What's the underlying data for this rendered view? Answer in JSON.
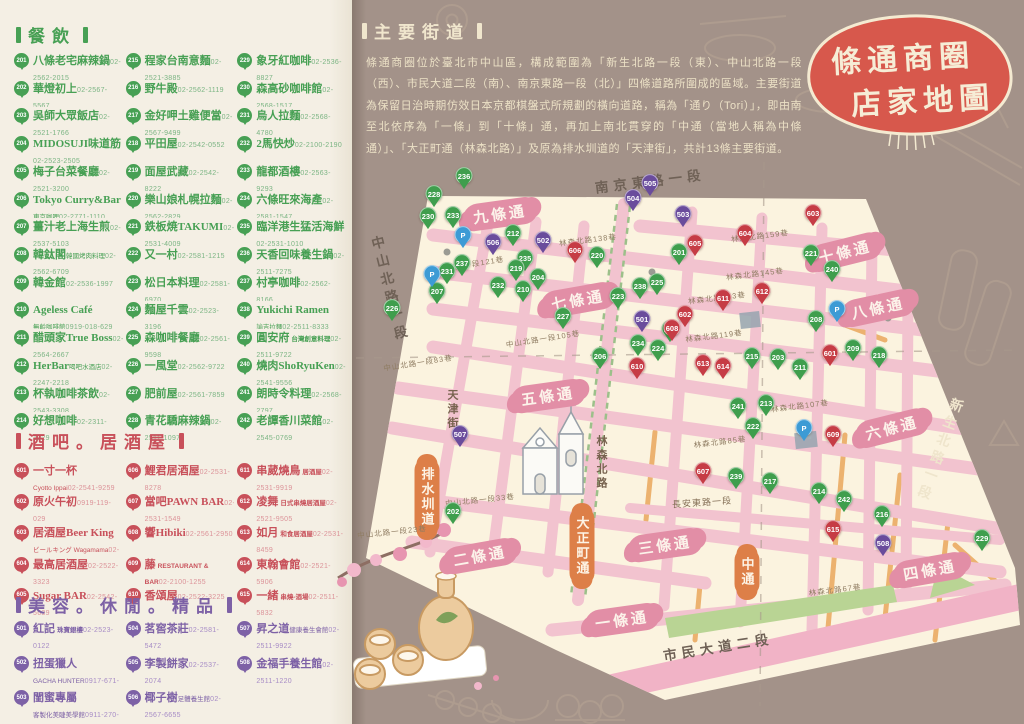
{
  "meta": {
    "title_line1": "條通商圈",
    "title_line2": "店家地圖"
  },
  "colors": {
    "accent_red": "#d7584c",
    "dining_green": "#47a054",
    "bar_red": "#c8505a",
    "beauty_purple": "#7d61a6",
    "map_cream": "#fbf3df",
    "road_pink": "#f2c3cf",
    "band_pink": "#e28ea6",
    "orange": "#dd7f48",
    "cream_text": "#efe5cc",
    "background_brown": "#a39289"
  },
  "sections": {
    "dining": {
      "title": "餐飲",
      "items": [
        {
          "n": 201,
          "name": "八條老宅麻辣鍋",
          "tel": "02-2562-2015"
        },
        {
          "n": 202,
          "name": "華燈初上",
          "tel": "02-2567-5567"
        },
        {
          "n": 203,
          "name": "吳師大眾飯店",
          "tel": "02-2521-1766"
        },
        {
          "n": 204,
          "name": "MIDOSUJI味道筋",
          "tel": "02-2523-2505"
        },
        {
          "n": 205,
          "name": "梅子台菜餐廳",
          "tel": "02-2521-3200"
        },
        {
          "n": 206,
          "name": "Tokyo Curry&Bar",
          "sub": "東京咖哩",
          "tel": "02-2771-1110"
        },
        {
          "n": 207,
          "name": "薑汁老上海生煎",
          "tel": "02-2537-5103"
        },
        {
          "n": 208,
          "name": "韓鈦閣",
          "sub": "韓國烤肉料理",
          "tel": "02-2562-6709"
        },
        {
          "n": 209,
          "name": "韓金館",
          "tel": "02-2536-1997"
        },
        {
          "n": 210,
          "name": "Ageless Café",
          "sub": "無齡咖啡館",
          "tel": "0919-018-629"
        },
        {
          "n": 211,
          "name": "醋頭家True Boss",
          "tel": "02-2564-2667"
        },
        {
          "n": 212,
          "name": "HerBar",
          "sub": "喝吧水酒店",
          "tel": "02-2247-2218"
        },
        {
          "n": 213,
          "name": "杯執咖啡茶飲",
          "tel": "02-2543-3308"
        },
        {
          "n": 214,
          "name": "好想咖啡",
          "tel": "02-2311-1329"
        },
        {
          "n": 215,
          "name": "程家台南意麵",
          "tel": "02-2521-3885"
        },
        {
          "n": 216,
          "name": "野牛殿",
          "tel": "02-2562-1119"
        },
        {
          "n": 217,
          "name": "金好呷土雞便當",
          "tel": "02-2567-9499"
        },
        {
          "n": 218,
          "name": "平田屋",
          "tel": "02-2542-0552"
        },
        {
          "n": 219,
          "name": "面屋武藏",
          "tel": "02-2542-8222"
        },
        {
          "n": 220,
          "name": "樂山娘札幌拉麵",
          "tel": "02-2562-2829"
        },
        {
          "n": 221,
          "name": "鉄板焼TAKUMI",
          "tel": "02-2531-4009"
        },
        {
          "n": 222,
          "name": "又一村",
          "tel": "02-2581-1215"
        },
        {
          "n": 223,
          "name": "松日本料理",
          "tel": "02-2581-6970"
        },
        {
          "n": 224,
          "name": "麵屋千雲",
          "tel": "02-2523-3196"
        },
        {
          "n": 225,
          "name": "森咖啡餐廳",
          "tel": "02-2561-9598"
        },
        {
          "n": 226,
          "name": "一風堂",
          "tel": "02-2562-9722"
        },
        {
          "n": 227,
          "name": "肥前屋",
          "tel": "02-2561-7859"
        },
        {
          "n": 228,
          "name": "青花驕麻辣鍋",
          "tel": "02-2511-1097"
        },
        {
          "n": 229,
          "name": "象牙紅咖啡",
          "tel": "02-2536-8827"
        },
        {
          "n": 230,
          "name": "森高砂咖啡館",
          "tel": "02-2568-1517"
        },
        {
          "n": 231,
          "name": "烏人拉麵",
          "tel": "02-2568-4780"
        },
        {
          "n": 232,
          "name": "2馬快炒",
          "tel": "02-2100-2190"
        },
        {
          "n": 233,
          "name": "龍都酒樓",
          "tel": "02-2563-9293"
        },
        {
          "n": 234,
          "name": "六條旺來海產",
          "tel": "02-2581-1547"
        },
        {
          "n": 235,
          "name": "臨洋港生猛活海鮮",
          "tel": "02-2531-1010"
        },
        {
          "n": 236,
          "name": "天香回味養生鍋",
          "tel": "02-2511-7275"
        },
        {
          "n": 237,
          "name": "村亭咖啡",
          "tel": "02-2562-8166"
        },
        {
          "n": 238,
          "name": "Yukichi Ramen",
          "sub": "諭吉拉麵",
          "tel": "02-2511-8333"
        },
        {
          "n": 239,
          "name": "圓安府",
          "subi": "台灣創意料理",
          "tel": "02-2511-9722"
        },
        {
          "n": 240,
          "name": "燒肉ShoRyuKen",
          "tel": "02-2541-9556"
        },
        {
          "n": 241,
          "name": "朗時令料理",
          "tel": "02-2568-2797"
        },
        {
          "n": 242,
          "name": "老譚香川菜館",
          "tel": "02-2545-0769"
        }
      ]
    },
    "bars": {
      "title": "酒吧。居酒屋",
      "items": [
        {
          "n": 601,
          "name": "一寸一杯",
          "sub": "Cyotto Ippai",
          "tel": "02-2541-9259"
        },
        {
          "n": 602,
          "name": "原火午初",
          "tel": "0919-119-029"
        },
        {
          "n": 603,
          "name": "居酒屋Beer King",
          "sub": "ビールキング Wagamama",
          "tel": "02-2523-8103"
        },
        {
          "n": 604,
          "name": "最高居酒屋",
          "tel": "02-2522-3323"
        },
        {
          "n": 605,
          "name": "Sugar BAR",
          "tel": "02-2542-5639"
        },
        {
          "n": 606,
          "name": "鯉君居酒屋",
          "tel": "02-2531-8278"
        },
        {
          "n": 607,
          "name": "當吧PAWN BAR",
          "tel": "02-2531-1549"
        },
        {
          "n": 608,
          "name": "響Hibiki",
          "tel": "02-2561-2950"
        },
        {
          "n": 609,
          "name": "藤",
          "subi": "RESTAURANT & BAR",
          "tel": "02-2100-1255"
        },
        {
          "n": 610,
          "name": "香頌屋",
          "tel": "02-2522-3225"
        },
        {
          "n": 611,
          "name": "串葳燒鳥",
          "subi": "居酒屋",
          "tel": "02-2531-9919"
        },
        {
          "n": 612,
          "name": "凌舞",
          "subi": "日式串燒居酒屋",
          "tel": "02-2521-9505"
        },
        {
          "n": 613,
          "name": "如月",
          "subi": "和食居酒屋",
          "tel": "02-2531-8459"
        },
        {
          "n": 614,
          "name": "東翰會館",
          "tel": "02-2521-5906"
        },
        {
          "n": 615,
          "name": "一緒",
          "subi": "串燒-酒場",
          "tel": "02-2511-5832"
        }
      ]
    },
    "beauty": {
      "title": "美容。休閒。精品",
      "items": [
        {
          "n": 501,
          "name": "紅記",
          "subi": "珠寶銀樓",
          "tel": "02-2523-0122"
        },
        {
          "n": 502,
          "name": "扭蛋獵人",
          "sub": "GACHA HUNTER",
          "tel": "0917-671-63"
        },
        {
          "n": 503,
          "name": "閨蜜專屬",
          "sub": "客製化美睫美學館",
          "tel": "0911-270-098"
        },
        {
          "n": 504,
          "name": "茗窖茶莊",
          "tel": "02-2581-5472"
        },
        {
          "n": 505,
          "name": "李製餅家",
          "tel": "02-2537-2074"
        },
        {
          "n": 506,
          "name": "椰子樹",
          "sub": "足體養生館",
          "tel": "02-2567-6655"
        },
        {
          "n": 507,
          "name": "昇之道",
          "sub": "健康養生會館",
          "tel": "02-2511-9922"
        },
        {
          "n": 508,
          "name": "金福手養生館",
          "tel": "02-2511-1220"
        }
      ]
    }
  },
  "main_streets": {
    "title": "主要街道",
    "body": "條通商圈位於臺北市中山區，構成範圍為「新生北路一段（東）、中山北路一段（西）、市民大道二段（南）、南京東路一段（北）」四條道路所圍成的區域。主要街道為保留日治時期仿效日本京都棋盤式所規劃的橫向道路，稱為「通り（Tori）」，即由南至北依序為「一條」到「十條」通，再加上南北貫穿的「中通（當地人稱為中條通）」、「大正町通（林森北路）」及原為排水圳道的「天津街」，共計13條主要街道。"
  },
  "map": {
    "labels": [
      {
        "t": "十條通",
        "x": 845,
        "y": 252,
        "rot": -14,
        "cls": "band"
      },
      {
        "t": "九條通",
        "x": 500,
        "y": 214,
        "rot": -8,
        "cls": "band"
      },
      {
        "t": "八條通",
        "x": 878,
        "y": 308,
        "rot": -12,
        "cls": "band"
      },
      {
        "t": "七條通",
        "x": 578,
        "y": 300,
        "rot": -10,
        "cls": "band"
      },
      {
        "t": "六條通",
        "x": 892,
        "y": 428,
        "rot": -14,
        "cls": "band"
      },
      {
        "t": "五條通",
        "x": 548,
        "y": 396,
        "rot": -8,
        "cls": "band"
      },
      {
        "t": "四條通",
        "x": 930,
        "y": 570,
        "rot": -10,
        "cls": "band"
      },
      {
        "t": "三條通",
        "x": 665,
        "y": 545,
        "rot": -8,
        "cls": "band"
      },
      {
        "t": "二條通",
        "x": 480,
        "y": 556,
        "rot": -10,
        "cls": "band"
      },
      {
        "t": "一條通",
        "x": 622,
        "y": 620,
        "rot": -8,
        "cls": "band"
      },
      {
        "t": "排水圳道",
        "x": 427,
        "y": 497,
        "cls": "oband vert"
      },
      {
        "t": "大正町通",
        "x": 582,
        "y": 546,
        "cls": "oband vert"
      },
      {
        "t": "中通",
        "x": 747,
        "y": 572,
        "cls": "oband vert"
      },
      {
        "t": "南京東路一段",
        "x": 650,
        "y": 180,
        "rot": -7,
        "cls": "road-big"
      },
      {
        "t": "新生北路一段",
        "x": 938,
        "y": 450,
        "rot": 20,
        "cls": "road-big cream vert"
      },
      {
        "t": "中山北路一段",
        "x": 388,
        "y": 290,
        "rot": -14,
        "cls": "road-big vert"
      },
      {
        "t": "市民大道二段",
        "x": 718,
        "y": 646,
        "rot": -9,
        "cls": "road-big"
      },
      {
        "t": "林森北路",
        "x": 601,
        "y": 463,
        "cls": "road-mid vert"
      },
      {
        "t": "天津街",
        "x": 452,
        "y": 410,
        "cls": "road-mid vert"
      },
      {
        "t": "長安東路一段",
        "x": 702,
        "y": 502,
        "rot": -4,
        "cls": "road-small"
      },
      {
        "t": "林森北路138巷",
        "x": 588,
        "y": 240,
        "rot": -7,
        "cls": "lane"
      },
      {
        "t": "林森北路159巷",
        "x": 760,
        "y": 236,
        "rot": -7,
        "cls": "lane"
      },
      {
        "t": "林森北路145巷",
        "x": 755,
        "y": 274,
        "rot": -7,
        "cls": "lane"
      },
      {
        "t": "林森北路133巷",
        "x": 717,
        "y": 298,
        "rot": -7,
        "cls": "lane"
      },
      {
        "t": "林森北路119巷",
        "x": 714,
        "y": 336,
        "rot": -7,
        "cls": "lane"
      },
      {
        "t": "林森北路107巷",
        "x": 800,
        "y": 406,
        "rot": -7,
        "cls": "lane"
      },
      {
        "t": "林森北路85巷",
        "x": 720,
        "y": 442,
        "rot": -7,
        "cls": "lane"
      },
      {
        "t": "林森北路67巷",
        "x": 835,
        "y": 590,
        "rot": -7,
        "cls": "lane"
      },
      {
        "t": "中山北路一段121巷",
        "x": 467,
        "y": 265,
        "rot": -9,
        "cls": "lane"
      },
      {
        "t": "中山北路一段105巷",
        "x": 543,
        "y": 339,
        "rot": -9,
        "cls": "lane"
      },
      {
        "t": "中山北路一段83巷",
        "x": 418,
        "y": 363,
        "rot": -9,
        "cls": "lane"
      },
      {
        "t": "中山北路一段33巷",
        "x": 480,
        "y": 500,
        "rot": -6,
        "cls": "lane"
      },
      {
        "t": "中山北路一段23巷",
        "x": 392,
        "y": 532,
        "rot": -6,
        "cls": "lane"
      }
    ],
    "pins": [
      {
        "n": 236,
        "x": 464,
        "y": 190,
        "c": "g"
      },
      {
        "n": 228,
        "x": 434,
        "y": 208,
        "c": "g"
      },
      {
        "n": 230,
        "x": 428,
        "y": 230,
        "c": "g"
      },
      {
        "n": 233,
        "x": 453,
        "y": 229,
        "c": "g"
      },
      {
        "n": 212,
        "x": 513,
        "y": 247,
        "c": "g"
      },
      {
        "n": 220,
        "x": 597,
        "y": 269,
        "c": "g"
      },
      {
        "n": 235,
        "x": 525,
        "y": 272,
        "c": "g"
      },
      {
        "n": 237,
        "x": 462,
        "y": 277,
        "c": "g"
      },
      {
        "n": 231,
        "x": 447,
        "y": 285,
        "c": "g"
      },
      {
        "n": 219,
        "x": 516,
        "y": 282,
        "c": "g"
      },
      {
        "n": 204,
        "x": 538,
        "y": 291,
        "c": "g"
      },
      {
        "n": 232,
        "x": 498,
        "y": 299,
        "c": "g"
      },
      {
        "n": 210,
        "x": 523,
        "y": 303,
        "c": "g"
      },
      {
        "n": 207,
        "x": 437,
        "y": 305,
        "c": "g"
      },
      {
        "n": 226,
        "x": 392,
        "y": 322,
        "c": "g"
      },
      {
        "n": 223,
        "x": 618,
        "y": 310,
        "c": "g"
      },
      {
        "n": 238,
        "x": 640,
        "y": 300,
        "c": "g"
      },
      {
        "n": 227,
        "x": 563,
        "y": 330,
        "c": "g"
      },
      {
        "n": 234,
        "x": 638,
        "y": 357,
        "c": "g"
      },
      {
        "n": 205,
        "x": 670,
        "y": 343,
        "c": "g"
      },
      {
        "n": 206,
        "x": 600,
        "y": 370,
        "c": "g"
      },
      {
        "n": 224,
        "x": 658,
        "y": 362,
        "c": "g"
      },
      {
        "n": 225,
        "x": 657,
        "y": 296,
        "c": "g"
      },
      {
        "n": 201,
        "x": 679,
        "y": 266,
        "c": "g"
      },
      {
        "n": 221,
        "x": 811,
        "y": 267,
        "c": "g"
      },
      {
        "n": 240,
        "x": 832,
        "y": 283,
        "c": "g"
      },
      {
        "n": 208,
        "x": 816,
        "y": 333,
        "c": "g"
      },
      {
        "n": 209,
        "x": 853,
        "y": 362,
        "c": "g"
      },
      {
        "n": 218,
        "x": 879,
        "y": 369,
        "c": "g"
      },
      {
        "n": 215,
        "x": 752,
        "y": 370,
        "c": "g"
      },
      {
        "n": 203,
        "x": 778,
        "y": 371,
        "c": "g"
      },
      {
        "n": 211,
        "x": 800,
        "y": 381,
        "c": "g"
      },
      {
        "n": 213,
        "x": 766,
        "y": 417,
        "c": "g"
      },
      {
        "n": 241,
        "x": 738,
        "y": 420,
        "c": "g"
      },
      {
        "n": 222,
        "x": 753,
        "y": 440,
        "c": "g"
      },
      {
        "n": 202,
        "x": 453,
        "y": 525,
        "c": "g"
      },
      {
        "n": 239,
        "x": 736,
        "y": 490,
        "c": "g"
      },
      {
        "n": 217,
        "x": 770,
        "y": 495,
        "c": "g"
      },
      {
        "n": 214,
        "x": 819,
        "y": 505,
        "c": "g"
      },
      {
        "n": 242,
        "x": 844,
        "y": 513,
        "c": "g"
      },
      {
        "n": 216,
        "x": 882,
        "y": 528,
        "c": "g"
      },
      {
        "n": 229,
        "x": 982,
        "y": 552,
        "c": "g"
      },
      {
        "n": 606,
        "x": 575,
        "y": 264,
        "c": "r"
      },
      {
        "n": 605,
        "x": 695,
        "y": 257,
        "c": "r"
      },
      {
        "n": 604,
        "x": 745,
        "y": 247,
        "c": "r"
      },
      {
        "n": 603,
        "x": 813,
        "y": 227,
        "c": "r"
      },
      {
        "n": 602,
        "x": 685,
        "y": 328,
        "c": "r"
      },
      {
        "n": 601,
        "x": 830,
        "y": 367,
        "c": "r"
      },
      {
        "n": 608,
        "x": 672,
        "y": 342,
        "c": "r"
      },
      {
        "n": 610,
        "x": 637,
        "y": 380,
        "c": "r"
      },
      {
        "n": 613,
        "x": 703,
        "y": 377,
        "c": "r"
      },
      {
        "n": 614,
        "x": 723,
        "y": 380,
        "c": "r"
      },
      {
        "n": 611,
        "x": 723,
        "y": 312,
        "c": "r"
      },
      {
        "n": 612,
        "x": 762,
        "y": 305,
        "c": "r"
      },
      {
        "n": 607,
        "x": 703,
        "y": 485,
        "c": "r"
      },
      {
        "n": 609,
        "x": 833,
        "y": 448,
        "c": "r"
      },
      {
        "n": 615,
        "x": 833,
        "y": 543,
        "c": "r"
      },
      {
        "n": 501,
        "x": 642,
        "y": 333,
        "c": "p"
      },
      {
        "n": 502,
        "x": 543,
        "y": 254,
        "c": "p"
      },
      {
        "n": 503,
        "x": 683,
        "y": 228,
        "c": "p"
      },
      {
        "n": 504,
        "x": 633,
        "y": 212,
        "c": "p"
      },
      {
        "n": 505,
        "x": 650,
        "y": 197,
        "c": "p"
      },
      {
        "n": 506,
        "x": 493,
        "y": 256,
        "c": "p"
      },
      {
        "n": 507,
        "x": 460,
        "y": 448,
        "c": "p"
      },
      {
        "n": 508,
        "x": 883,
        "y": 557,
        "c": "p"
      },
      {
        "n": "P",
        "x": 463,
        "y": 249,
        "c": "b"
      },
      {
        "n": "P",
        "x": 432,
        "y": 288,
        "c": "b"
      },
      {
        "n": "P",
        "x": 837,
        "y": 323,
        "c": "b"
      },
      {
        "n": "P",
        "x": 804,
        "y": 442,
        "c": "b"
      }
    ]
  }
}
